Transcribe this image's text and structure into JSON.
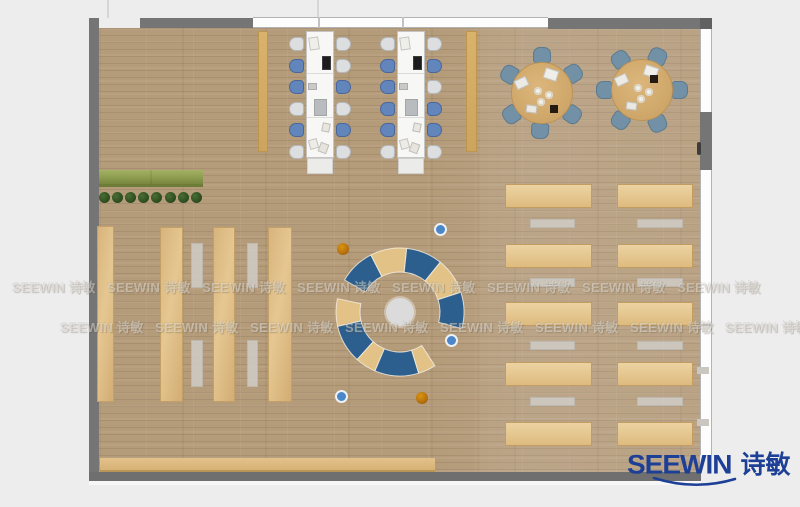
{
  "watermark": {
    "text": "SEEWIN 诗敏",
    "rows": [
      {
        "y": 277,
        "x0": 12,
        "dx": 95,
        "count": 8
      },
      {
        "y": 317,
        "x0": 60,
        "dx": 95,
        "count": 8
      }
    ]
  },
  "logo": {
    "brand": "SEEWIN",
    "cn": "诗敏",
    "color": "#1d3f96"
  },
  "colors": {
    "background": "#ededed",
    "wall": "#757575",
    "floor": "#b49b7a",
    "wood": "#dcba82",
    "wood_dark": "#c29c60",
    "runner": "rgba(206,202,194,0.9)",
    "table_white": "#f7f7f6",
    "chair_light": "#dcdee0",
    "chair_blue": "#6286bb",
    "chair_slate": "#7391a6",
    "round_table": "#d2ab72",
    "arc_blue": "#2c5f8d",
    "arc_tan": "#e2c287",
    "circle_gray": "#dbdbdb",
    "dot_blue": "#4a86c8",
    "dot_orange": "#c9800f",
    "bench_green": "#8d9c4f",
    "plant_green": "#2c4d20"
  },
  "plan": {
    "shelves": [
      {
        "x": 97,
        "y": 226,
        "w": 17,
        "h": 176
      },
      {
        "x": 160,
        "y": 227,
        "w": 23,
        "h": 175
      },
      {
        "x": 213,
        "y": 227,
        "w": 22,
        "h": 175
      },
      {
        "x": 268,
        "y": 227,
        "w": 24,
        "h": 175
      }
    ],
    "runners": [
      {
        "x": 191,
        "y": 243,
        "w": 12,
        "h": 45
      },
      {
        "x": 191,
        "y": 340,
        "w": 12,
        "h": 47
      },
      {
        "x": 247,
        "y": 243,
        "w": 11,
        "h": 45
      },
      {
        "x": 247,
        "y": 340,
        "w": 11,
        "h": 47
      }
    ],
    "side_benches": [
      {
        "x": 258,
        "y": 31,
        "w": 10,
        "h": 121
      },
      {
        "x": 466,
        "y": 31,
        "w": 11,
        "h": 121
      }
    ],
    "green_bench": {
      "x": 99,
      "y": 170,
      "w": 104,
      "h": 17
    },
    "plants": {
      "count": 8,
      "x0": 104,
      "dx": 13.2,
      "y": 197,
      "size": 11
    },
    "long_tables": [
      {
        "x": 306,
        "y": 31,
        "w": 28,
        "h": 127,
        "chairs_left": [
          "light",
          "blue",
          "blue",
          "light",
          "blue",
          "light"
        ],
        "chairs_right": [
          "light",
          "light",
          "blue",
          "light",
          "blue",
          "light"
        ]
      },
      {
        "x": 397,
        "y": 31,
        "w": 28,
        "h": 127,
        "chairs_left": [
          "light",
          "blue",
          "blue",
          "blue",
          "blue",
          "light"
        ],
        "chairs_right": [
          "light",
          "blue",
          "light",
          "blue",
          "blue",
          "light"
        ]
      }
    ],
    "table_items": [
      {
        "dx": 3,
        "dy": 6,
        "w": 10,
        "h": 13,
        "c": "#efefe9",
        "rot": -8
      },
      {
        "dx": 16,
        "dy": 25,
        "w": 9,
        "h": 14,
        "c": "#1c1c1e",
        "rot": 0
      },
      {
        "dx": 2,
        "dy": 52,
        "w": 9,
        "h": 7,
        "c": "#c9c9c9",
        "rot": 0
      },
      {
        "dx": 8,
        "dy": 68,
        "w": 13,
        "h": 17,
        "c": "#b9bcbe",
        "rot": 0
      },
      {
        "dx": 16,
        "dy": 92,
        "w": 8,
        "h": 9,
        "c": "#e8e6df",
        "rot": 12
      },
      {
        "dx": 3,
        "dy": 108,
        "w": 9,
        "h": 10,
        "c": "#eeece6",
        "rot": -15
      },
      {
        "dx": 13,
        "dy": 112,
        "w": 9,
        "h": 10,
        "c": "#e6e4dd",
        "rot": 20
      }
    ],
    "round_tables": [
      {
        "cx": 542,
        "cy": 93,
        "r": 31,
        "chairs": [
          32,
          90,
          150,
          215,
          267,
          325
        ],
        "dark_sq": {
          "dx": 8,
          "dy": 12
        }
      },
      {
        "cx": 642,
        "cy": 90,
        "r": 31,
        "chairs": [
          0,
          65,
          125,
          180,
          235,
          295
        ],
        "dark_sq": {
          "dx": 8,
          "dy": -15
        }
      }
    ],
    "round_items": [
      {
        "dx": -27,
        "dy": -15,
        "w": 13,
        "h": 10,
        "c": "#eceae4",
        "rot": -25
      },
      {
        "dx": 2,
        "dy": -24,
        "w": 14,
        "h": 11,
        "c": "#f0eee8",
        "rot": 18
      },
      {
        "dx": -16,
        "dy": 12,
        "w": 11,
        "h": 8,
        "c": "#eae8e1",
        "rot": 8
      }
    ],
    "plates": [
      {
        "dx": -8,
        "dy": -6
      },
      {
        "dx": 3,
        "dy": -2
      },
      {
        "dx": -5,
        "dy": 5
      }
    ],
    "reading_circle": {
      "cx": 400,
      "cy": 312,
      "rc": 14,
      "rin": 40,
      "rout": 64,
      "segments": [
        {
          "a0": 117,
          "a1": 150,
          "c": "blue"
        },
        {
          "a0": 84,
          "a1": 117,
          "c": "tan"
        },
        {
          "a0": 51,
          "a1": 84,
          "c": "blue"
        },
        {
          "a0": 18,
          "a1": 51,
          "c": "tan"
        },
        {
          "a0": -15,
          "a1": 18,
          "c": "blue"
        },
        {
          "a0": 168,
          "a1": 193,
          "c": "tan"
        },
        {
          "a0": 193,
          "a1": 228,
          "c": "blue"
        },
        {
          "a0": 228,
          "a1": 247,
          "c": "tan"
        },
        {
          "a0": 247,
          "a1": 287,
          "c": "blue"
        },
        {
          "a0": 287,
          "a1": 303,
          "c": "tan"
        }
      ]
    },
    "dots": [
      {
        "x": 442,
        "y": 231,
        "t": "blue"
      },
      {
        "x": 453,
        "y": 342,
        "t": "blue"
      },
      {
        "x": 343,
        "y": 398,
        "t": "blue"
      },
      {
        "x": 343,
        "y": 249,
        "t": "orange"
      },
      {
        "x": 422,
        "y": 398,
        "t": "orange"
      }
    ],
    "desk_columns": [
      {
        "x": 505,
        "w": 87
      },
      {
        "x": 617,
        "w": 76
      }
    ],
    "desk_runner_cols": [
      {
        "x": 530,
        "w": 45
      },
      {
        "x": 637,
        "w": 46
      }
    ],
    "desk_row_ys": [
      184,
      244,
      302,
      362,
      422
    ],
    "desk_row_h": 24,
    "desk_runner_ys": [
      219,
      278,
      341,
      397
    ],
    "desk_runner_h": 9,
    "bottom_counter": {
      "x": 100,
      "y": 458,
      "w": 335,
      "h": 14
    }
  }
}
